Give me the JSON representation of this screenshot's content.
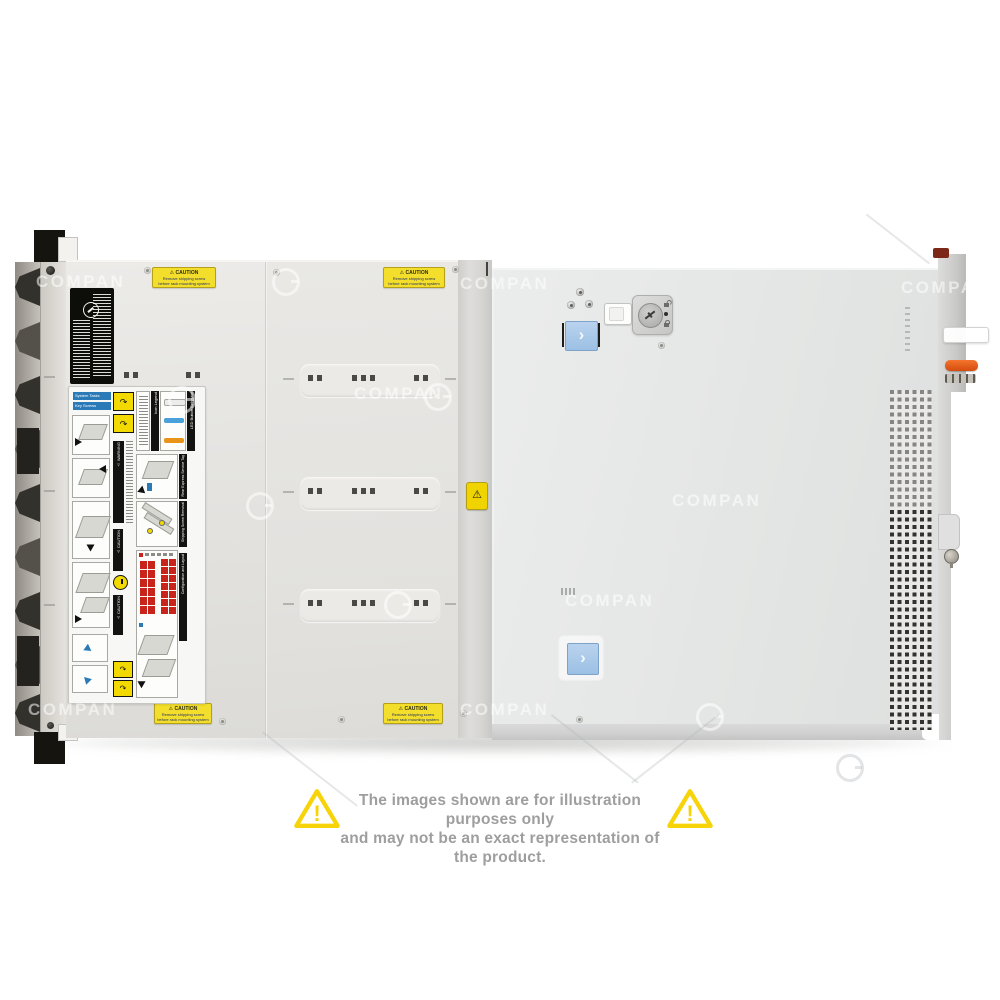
{
  "disclaimer": {
    "line1": "The images shown are for illustration purposes only",
    "line2": "and may not be an exact representation of the product."
  },
  "watermark": {
    "text": "COMPAN",
    "items": [
      {
        "type": "text",
        "tone": "light",
        "x": 36,
        "y": 272
      },
      {
        "type": "ring",
        "tone": "light",
        "x": 272,
        "y": 268
      },
      {
        "type": "text",
        "tone": "light",
        "x": 460,
        "y": 274
      },
      {
        "type": "text",
        "tone": "light",
        "x": 901,
        "y": 278
      },
      {
        "type": "ring",
        "tone": "light",
        "x": 168,
        "y": 386
      },
      {
        "type": "text",
        "tone": "light",
        "x": 354,
        "y": 384
      },
      {
        "type": "ring",
        "tone": "light",
        "x": 424,
        "y": 383
      },
      {
        "type": "text",
        "tone": "light",
        "x": 672,
        "y": 491
      },
      {
        "type": "ring",
        "tone": "light",
        "x": 246,
        "y": 492
      },
      {
        "type": "ring",
        "tone": "light",
        "x": 384,
        "y": 591
      },
      {
        "type": "text",
        "tone": "light",
        "x": 565,
        "y": 591
      },
      {
        "type": "text",
        "tone": "light",
        "x": 28,
        "y": 700
      },
      {
        "type": "text",
        "tone": "light",
        "x": 460,
        "y": 700
      },
      {
        "type": "ring",
        "tone": "light",
        "x": 696,
        "y": 703
      },
      {
        "type": "ring",
        "tone": "dark",
        "x": 836,
        "y": 754
      }
    ]
  },
  "caution_label": {
    "title": "⚠ CAUTION",
    "line1": "Remove shipping screw",
    "line2": "before rack mounting system"
  },
  "service_label": {
    "headers": [
      "System Tasks",
      "Key Screws",
      "Icon Legend",
      "LED Button Behavior",
      "Rear Express Service Tag",
      "Shipping Screw Removal",
      "Configuration and Layout"
    ],
    "warning": "⚠ WARNING",
    "caution_1": "⚠ CAUTION",
    "caution_2": "⚠ CAUTION",
    "arrow_glyph": "↷"
  },
  "cover": {
    "chevron": "›",
    "divider_sticker_glyph": "⚠"
  },
  "colors": {
    "label_yellow": "#f3de2c",
    "button_blue": "#a9c8e8",
    "lever_orange": "#e05a18",
    "led_blue": "#4aa0d8",
    "led_orange": "#e8941a",
    "matrix_red": "#c8241a",
    "triangle_yellow": "#f7d40a",
    "disclaimer_gray": "#9e9e9e"
  }
}
